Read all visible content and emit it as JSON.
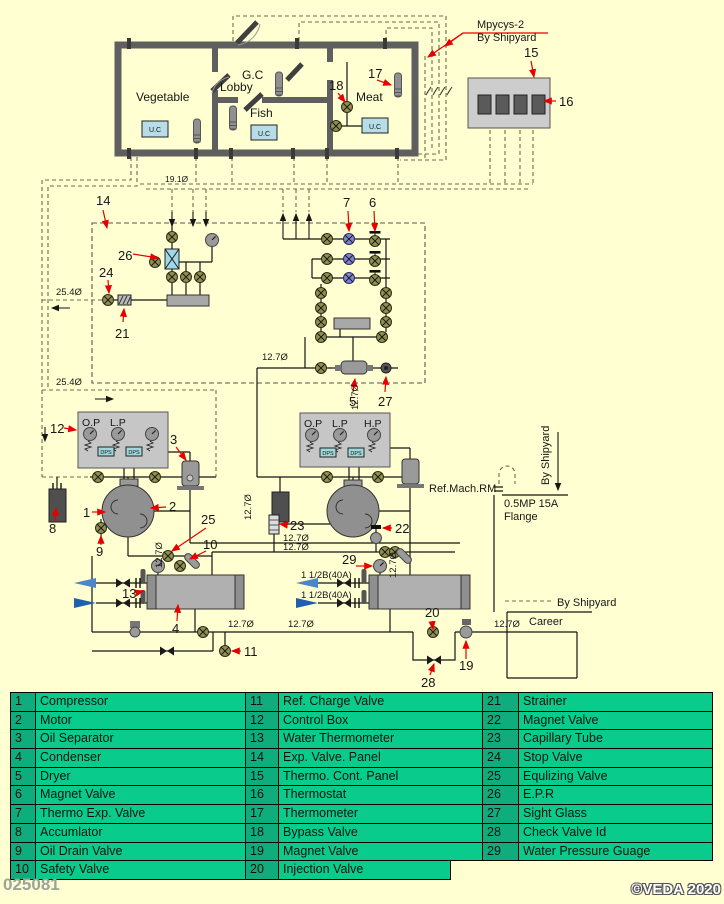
{
  "meta": {
    "doc_number": "025081",
    "copyright": "©VEDA 2020"
  },
  "rooms": {
    "vegetable": "Vegetable",
    "lobby": "Lobby",
    "gc": "G.C",
    "fish": "Fish",
    "meat": "Meat",
    "unit_cooler": "U.C"
  },
  "labels": {
    "mpycys": "Mpycys-2",
    "by_shipyard": "By Shipyard",
    "career": "Career",
    "ref_mach_rm": "Ref.Mach.RM",
    "flange_line1": "0.5MP 15A",
    "flange_line2": "Flange",
    "gauge_op": "O.P",
    "gauge_lp": "L.P",
    "gauge_hp": "H.P",
    "pressure_switch": "DPS",
    "pipe_25_4": "25.4Ø",
    "pipe_19_1": "19.1Ø",
    "pipe_12_7": "12.7Ø",
    "water_pipe_size": "1 1/2B(40A)"
  },
  "callouts": {
    "1": "1",
    "2": "2",
    "3": "3",
    "4": "4",
    "5": "5",
    "6": "6",
    "7": "7",
    "8": "8",
    "9": "9",
    "10": "10",
    "11": "11",
    "12": "12",
    "13": "13",
    "14": "14",
    "15": "15",
    "16": "16",
    "17": "17",
    "18": "18",
    "19": "19",
    "20": "20",
    "21": "21",
    "22": "22",
    "23": "23",
    "24": "24",
    "25": "25",
    "26": "26",
    "27": "27",
    "28": "28",
    "29": "29"
  },
  "legend": {
    "col1": [
      {
        "num": "1",
        "label": "Compressor"
      },
      {
        "num": "2",
        "label": "Motor"
      },
      {
        "num": "3",
        "label": "Oil Separator"
      },
      {
        "num": "4",
        "label": "Condenser"
      },
      {
        "num": "5",
        "label": "Dryer"
      },
      {
        "num": "6",
        "label": "Magnet Valve"
      },
      {
        "num": "7",
        "label": "Thermo Exp. Valve"
      },
      {
        "num": "8",
        "label": "Accumlator"
      },
      {
        "num": "9",
        "label": "Oil Drain Valve"
      },
      {
        "num": "10",
        "label": "Safety Valve"
      }
    ],
    "col2": [
      {
        "num": "11",
        "label": "Ref. Charge Valve"
      },
      {
        "num": "12",
        "label": "Control Box"
      },
      {
        "num": "13",
        "label": "Water Thermometer"
      },
      {
        "num": "14",
        "label": "Exp. Valve. Panel"
      },
      {
        "num": "15",
        "label": "Thermo. Cont. Panel"
      },
      {
        "num": "16",
        "label": "Thermostat"
      },
      {
        "num": "17",
        "label": "Thermometer"
      },
      {
        "num": "18",
        "label": "Bypass Valve"
      },
      {
        "num": "19",
        "label": "Magnet Valve"
      },
      {
        "num": "20",
        "label": "Injection Valve"
      }
    ],
    "col3": [
      {
        "num": "21",
        "label": "Strainer"
      },
      {
        "num": "22",
        "label": "Magnet Valve"
      },
      {
        "num": "23",
        "label": "Capillary Tube"
      },
      {
        "num": "24",
        "label": "Stop Valve"
      },
      {
        "num": "25",
        "label": "Equlizing Valve"
      },
      {
        "num": "26",
        "label": "E.P.R"
      },
      {
        "num": "27",
        "label": "Sight Glass"
      },
      {
        "num": "28",
        "label": "Check Valve Id"
      },
      {
        "num": "29",
        "label": "Water Pressure Guage"
      }
    ]
  },
  "colors": {
    "background": "#FFFFD2",
    "callout_red": "#E60000",
    "water_out_blue": "#4A86C8",
    "water_in_blue": "#1F5FAE",
    "valve_olive": "#8F8F4F",
    "tev_blue": "#7B85D4",
    "epr_cyan": "#9FD8E8",
    "legend_num_green": "#0FAC7D",
    "legend_cell_green": "#09CC8C"
  }
}
